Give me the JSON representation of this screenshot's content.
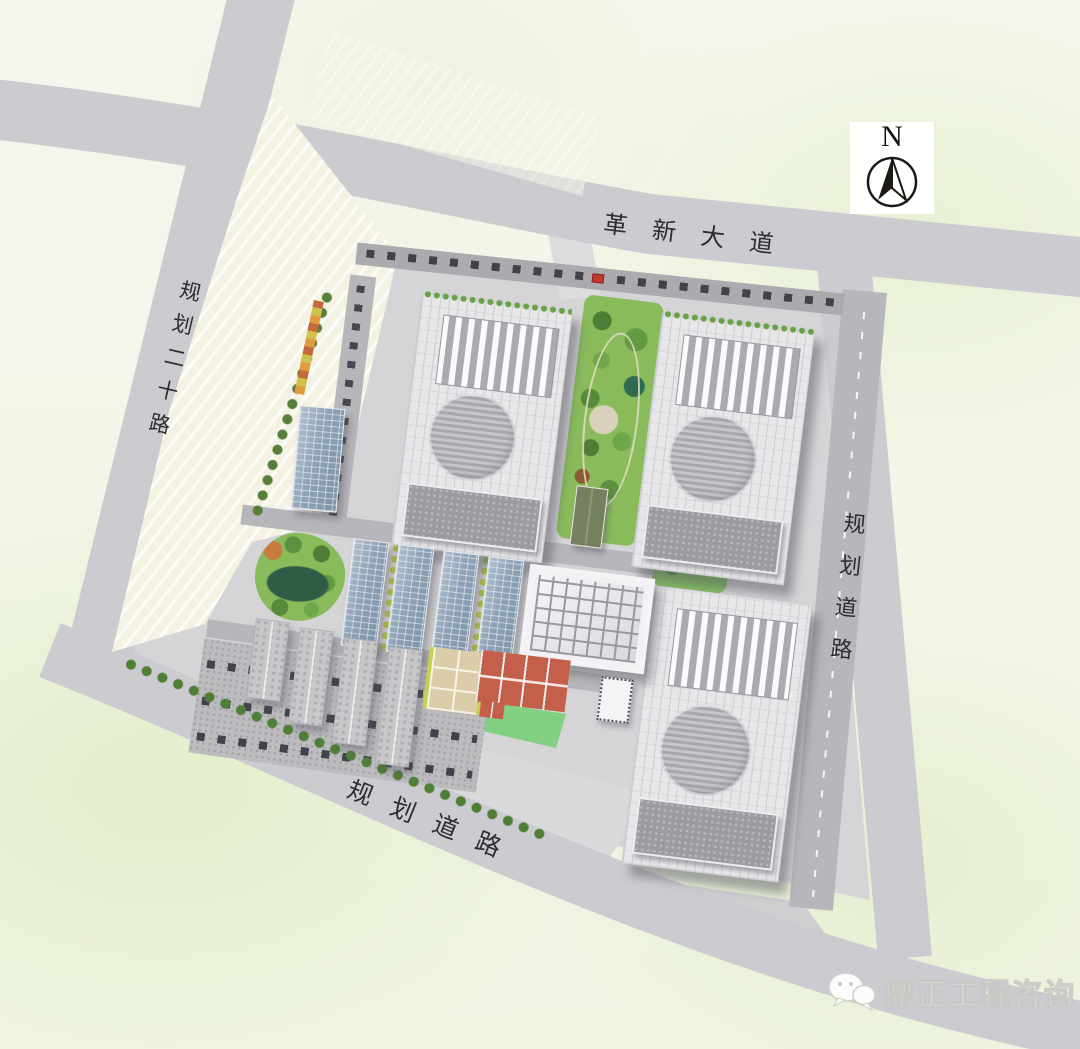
{
  "title": "site-master-plan",
  "roads": {
    "top": {
      "label": "革新大道"
    },
    "left": {
      "label": "规划二十路"
    },
    "right": {
      "label": "规划道路"
    },
    "bottom": {
      "label": "规划道路"
    }
  },
  "compass": {
    "label": "N",
    "icon": "north-arrow-icon"
  },
  "watermark": {
    "icon": "wechat-icon",
    "text": "鼎正工程咨询"
  },
  "colors": {
    "background": "#f1f5e4",
    "road": "#cbcbd0",
    "site_paving": "#d5d5d7",
    "warehouse_roof": "#e7e7e9",
    "skylight_stripe": "#fbfbfc",
    "annex_roof": "#9b9ca0",
    "solar_roof": "#8fa3b8",
    "park_green": "#8abb5b",
    "pond": "#2f5c45",
    "court_red": "#c4604a",
    "court_tan": "#dbcda9",
    "lawn": "#82d182"
  }
}
